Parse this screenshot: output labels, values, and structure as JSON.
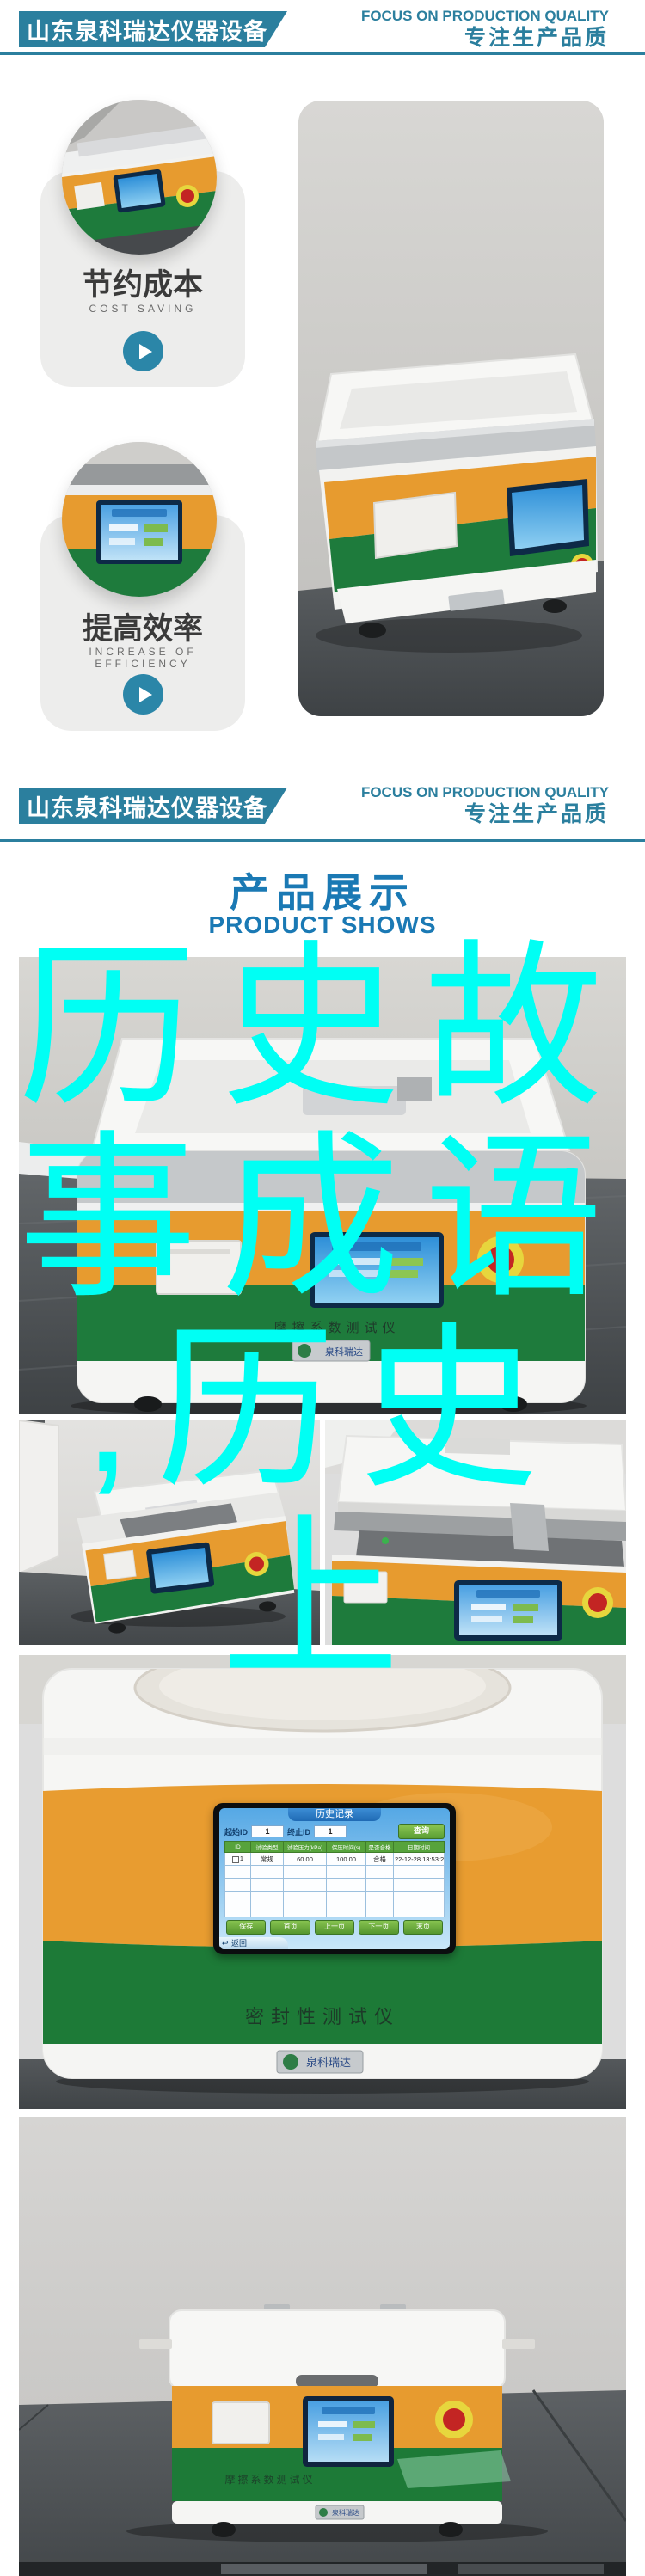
{
  "header": {
    "brand": "山东泉科瑞达仪器设备",
    "slogan_en": "FOCUS ON PRODUCTION QUALITY",
    "slogan_zh": "专注生产品质"
  },
  "colors": {
    "brand_teal": "#2b7f9e",
    "title_blue": "#1a79b4",
    "overlay_cyan": "#00fff4",
    "machine_orange": "#e79b2f",
    "machine_green": "#1e7b3c"
  },
  "features": [
    {
      "title": "节约成本",
      "subtitle": "COST SAVING"
    },
    {
      "title": "提高效率",
      "subtitle": "INCREASE OF EFFICIENCY"
    }
  ],
  "products_section": {
    "title_zh": "产品展示",
    "title_en": "PRODUCT SHOWS"
  },
  "overlay": {
    "text": "历史故事成语,历史上",
    "lines": [
      "历史故",
      "事成语",
      ",历史",
      "上"
    ]
  },
  "machine_labels": {
    "friction_tester": "摩擦系数测试仪",
    "seal_tester": "密封性测试仪",
    "logo_plate": "泉科瑞达"
  },
  "touchscreen": {
    "title": "历史记录",
    "start_id_label": "起始ID",
    "start_id_value": "1",
    "end_id_label": "终止ID",
    "end_id_value": "1",
    "query_button": "查询",
    "columns": [
      "ID",
      "试验类型",
      "试验压力(kPa)",
      "保压时间(s)",
      "是否合格",
      "日期时间"
    ],
    "row": [
      "1",
      "常规",
      "60.00",
      "100.00",
      "合格",
      "22-12-28 13:53:25"
    ],
    "nav_buttons": [
      "保存",
      "首页",
      "上一页",
      "下一页",
      "末页"
    ],
    "back_button": "返回"
  }
}
